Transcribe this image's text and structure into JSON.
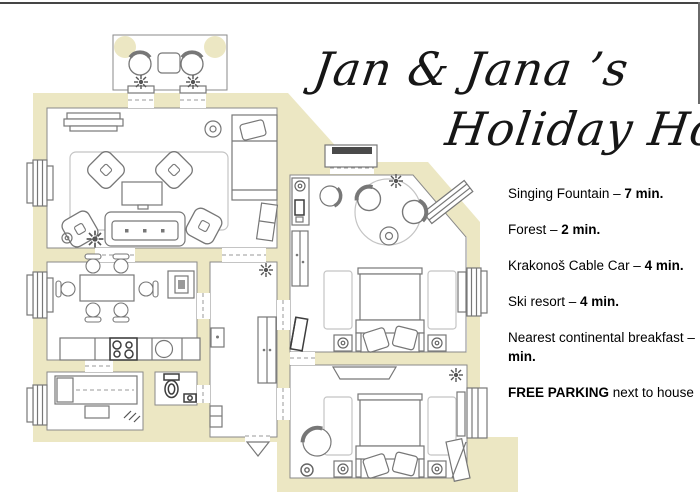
{
  "title": {
    "line1": "Jan & Jana ’s",
    "line2": "Holiday Home"
  },
  "info_items": [
    {
      "pre": "Singing Fountain – ",
      "bold": "7 min.",
      "post": ""
    },
    {
      "pre": "Forest – ",
      "bold": "2 min.",
      "post": ""
    },
    {
      "pre": "Krakonoš Cable Car – ",
      "bold": "4 min.",
      "post": ""
    },
    {
      "pre": "Ski resort – ",
      "bold": "4 min.",
      "post": ""
    },
    {
      "pre": "Nearest continental breakfast – ",
      "bold": "min.",
      "post": ""
    },
    {
      "pre": "",
      "bold": "FREE PARKING",
      "post": " next to house"
    }
  ],
  "floor_plan": {
    "colors": {
      "wall_fill": "#ece7c3",
      "outline_gray": "#8a8a8a",
      "furniture_gray": "#777777",
      "dark_accent": "#3d3d3d",
      "text_black": "#000000"
    }
  }
}
